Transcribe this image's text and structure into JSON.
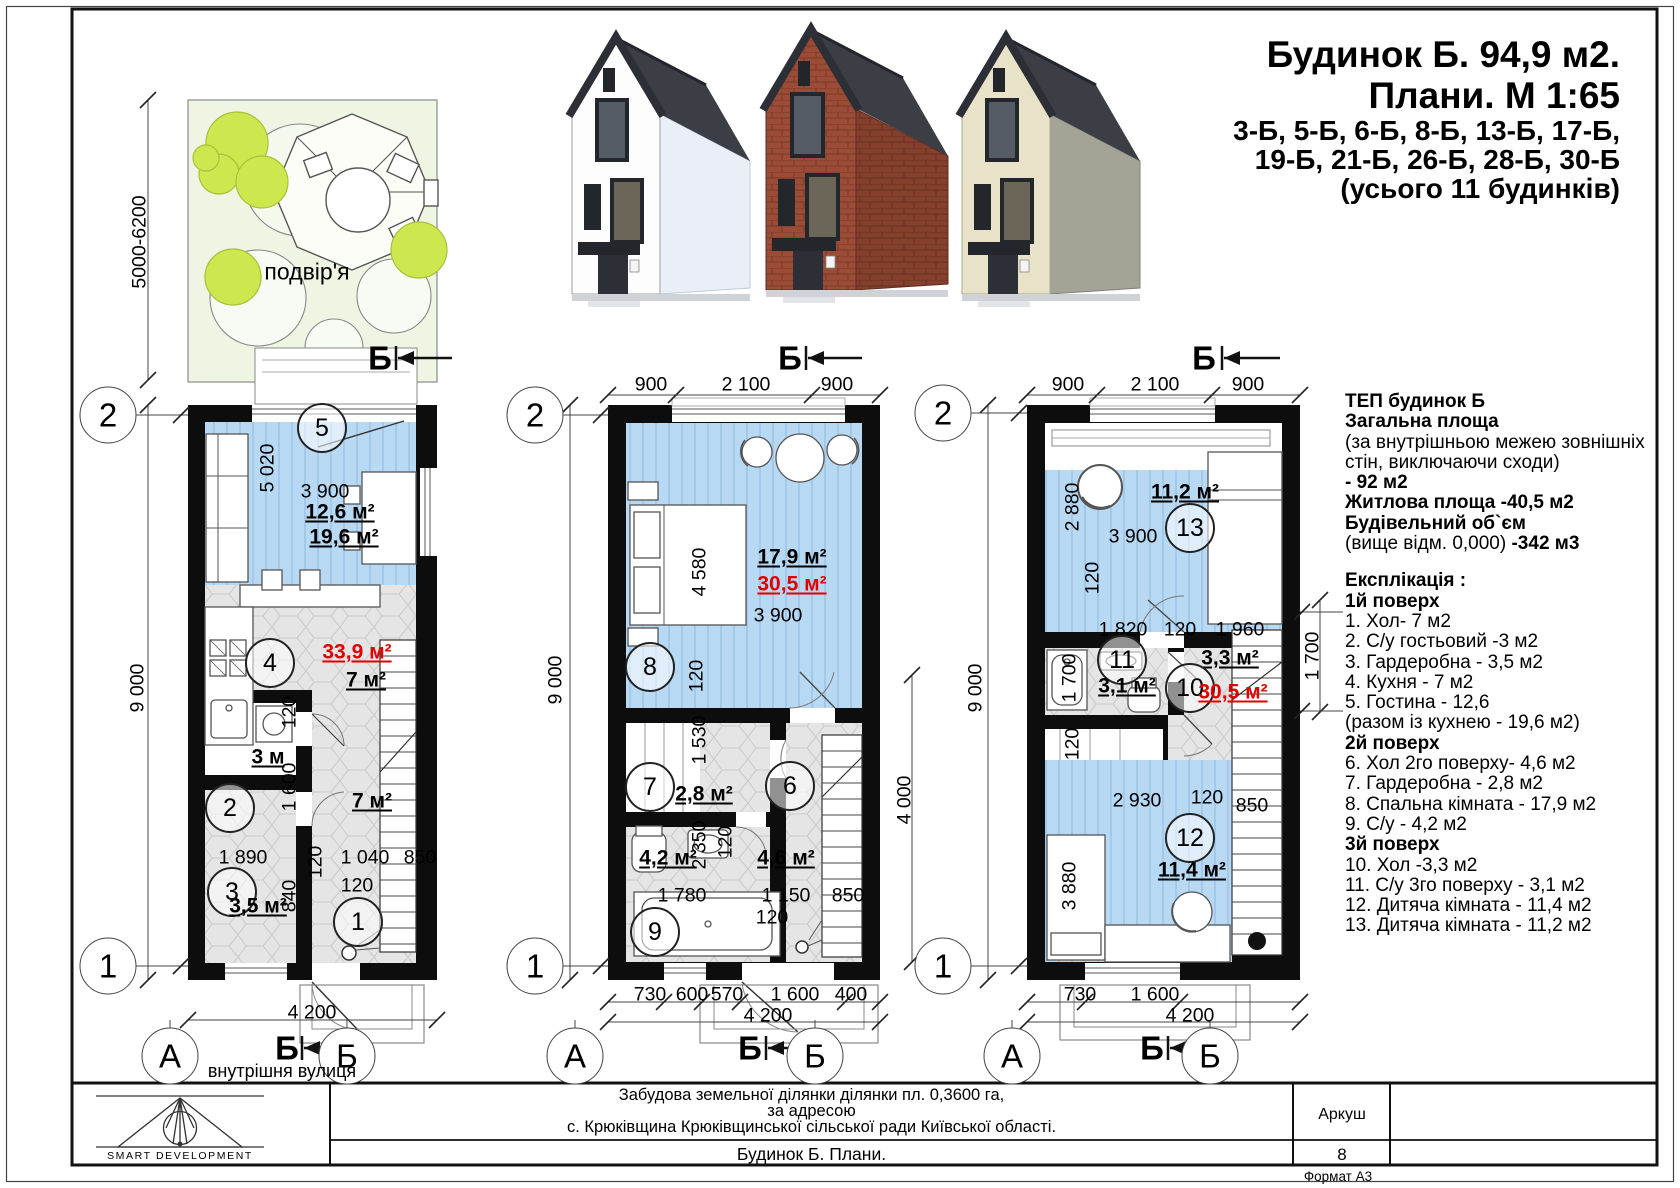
{
  "colors": {
    "accent_red": "#e10000",
    "room_blue": "#b8d9f3",
    "floor_hex_gray": "#e5e5e5",
    "yard_green": "#eef6e3",
    "tree_green": "#cde74f",
    "wall_black": "#0d0d0d"
  },
  "title": {
    "l1": "Будинок Б. 94,9 м2.",
    "l2": "Плани. М 1:65",
    "l3": "3-Б, 5-Б, 6-Б, 8-Б, 13-Б, 17-Б,",
    "l4": "19-Б,  21-Б,  26-Б, 28-Б,  30-Б",
    "l5": "(усього 11 будинків)"
  },
  "info": {
    "lines": [
      {
        "t": "ТЕП будинок Б",
        "cls": "b"
      },
      {
        "t": "Загальна площа",
        "cls": "b"
      },
      {
        "t": "(за внутрішньою межею зовнішніх"
      },
      {
        "t": "стін, виключаючи сходи)"
      },
      {
        "t": "- 92 м2",
        "cls": "b"
      },
      {
        "t": "Житлова площа -40,5 м2",
        "cls": "b"
      },
      {
        "t": "Будівельний об`єм",
        "cls": "b"
      },
      {
        "t": "(вище відм. 0,000) ",
        "t2": "-342 м3"
      },
      {
        "t": "",
        "cls": "gap"
      },
      {
        "t": "Експлікація :",
        "cls": "b"
      },
      {
        "t": "1й поверх",
        "cls": "b"
      },
      {
        "t": "1. Хол- 7 м2"
      },
      {
        "t": "2. С/у гостьовий -3 м2"
      },
      {
        "t": "3. Гардеробна - 3,5 м2"
      },
      {
        "t": "4. Кухня - 7 м2"
      },
      {
        "t": "5. Гостина - 12,6"
      },
      {
        "t": "(разом із кухнею - 19,6 м2)"
      },
      {
        "t": "2й поверх",
        "cls": "b"
      },
      {
        "t": "6. Хол 2го поверху- 4,6 м2"
      },
      {
        "t": "7. Гардеробна - 2,8 м2"
      },
      {
        "t": "8. Спальна кімната - 17,9 м2"
      },
      {
        "t": "9. С/у - 4,2 м2"
      },
      {
        "t": "3й поверх",
        "cls": "b"
      },
      {
        "t": "10. Хол -3,3 м2"
      },
      {
        "t": "11. С/у 3го поверху - 3,1 м2"
      },
      {
        "t": "12. Дитяча кімната - 11,4 м2"
      },
      {
        "t": "13. Дитяча кімната - 11,2 м2"
      }
    ]
  },
  "titleblock": {
    "project1": "Забудова земельної ділянки  ділянки пл. 0,3600 га,",
    "project2": "за адресою",
    "project3": "с. Крюківщина Крюківщинської сільської ради Київської області.",
    "doc_title": "Будинок Б. Плани.",
    "sheet_label": "Аркуш",
    "sheet_no": "8",
    "format": "Формат А3",
    "logo": "SMART DEVELOPMENT"
  },
  "labels": {
    "common": [
      {
        "t": "2",
        "x": 108,
        "y": 415,
        "cls": "grid"
      },
      {
        "t": "1",
        "x": 108,
        "y": 966,
        "cls": "grid"
      },
      {
        "t": "2",
        "x": 535,
        "y": 415,
        "cls": "grid"
      },
      {
        "t": "1",
        "x": 535,
        "y": 966,
        "cls": "grid"
      },
      {
        "t": "2",
        "x": 943,
        "y": 413,
        "cls": "grid"
      },
      {
        "t": "1",
        "x": 943,
        "y": 966,
        "cls": "grid"
      },
      {
        "t": "А",
        "x": 170,
        "y": 1056,
        "cls": "grid"
      },
      {
        "t": "Б",
        "x": 347,
        "y": 1056,
        "cls": "grid"
      },
      {
        "t": "А",
        "x": 575,
        "y": 1056,
        "cls": "grid"
      },
      {
        "t": "Б",
        "x": 815,
        "y": 1056,
        "cls": "grid"
      },
      {
        "t": "А",
        "x": 1012,
        "y": 1056,
        "cls": "grid"
      },
      {
        "t": "Б",
        "x": 1210,
        "y": 1056,
        "cls": "grid"
      },
      {
        "t": "Б",
        "x": 380,
        "y": 358,
        "cls": "sec"
      },
      {
        "t": "Б",
        "x": 790,
        "y": 358,
        "cls": "sec"
      },
      {
        "t": "Б",
        "x": 1204,
        "y": 358,
        "cls": "sec"
      },
      {
        "t": "Б",
        "x": 287,
        "y": 1048,
        "cls": "sec"
      },
      {
        "t": "Б",
        "x": 750,
        "y": 1048,
        "cls": "sec"
      },
      {
        "t": "Б",
        "x": 1152,
        "y": 1048,
        "cls": "sec"
      },
      {
        "t": "подвір'я",
        "x": 307,
        "y": 272,
        "cls": "yard"
      },
      {
        "t": "внутрішня вулиця",
        "x": 282,
        "y": 1071,
        "cls": "street"
      },
      {
        "t": "5000-6200",
        "x": 140,
        "y": 242,
        "cls": "rot"
      }
    ],
    "floor1": [
      {
        "t": "9 000",
        "x": 138,
        "y": 688,
        "cls": "rot"
      },
      {
        "t": "5 020",
        "x": 268,
        "y": 468,
        "cls": "rot"
      },
      {
        "t": "3 900",
        "x": 325,
        "y": 492
      },
      {
        "t": "12,6 м²",
        "x": 340,
        "y": 512,
        "cls": "area"
      },
      {
        "t": "19,6 м²",
        "x": 344,
        "y": 537,
        "cls": "area"
      },
      {
        "t": "5",
        "x": 322,
        "y": 428,
        "cls": "room"
      },
      {
        "t": "4",
        "x": 270,
        "y": 663,
        "cls": "room"
      },
      {
        "t": "33,9 м²",
        "x": 357,
        "y": 652,
        "cls": "area red"
      },
      {
        "t": "7 м²",
        "x": 366,
        "y": 680,
        "cls": "area"
      },
      {
        "t": "120",
        "x": 290,
        "y": 712,
        "cls": "rot"
      },
      {
        "t": "3 м",
        "x": 268,
        "y": 757,
        "cls": "area"
      },
      {
        "t": "2",
        "x": 230,
        "y": 808,
        "cls": "room"
      },
      {
        "t": "1 600",
        "x": 290,
        "y": 787,
        "cls": "rot"
      },
      {
        "t": "7 м²",
        "x": 372,
        "y": 801,
        "cls": "area"
      },
      {
        "t": "1 890",
        "x": 243,
        "y": 858
      },
      {
        "t": "120",
        "x": 316,
        "y": 862,
        "cls": "rot"
      },
      {
        "t": "1 040",
        "x": 365,
        "y": 858
      },
      {
        "t": "850",
        "x": 420,
        "y": 858
      },
      {
        "t": "120",
        "x": 357,
        "y": 886
      },
      {
        "t": "840",
        "x": 290,
        "y": 896,
        "cls": "rot"
      },
      {
        "t": "3",
        "x": 232,
        "y": 892,
        "cls": "room"
      },
      {
        "t": "3,5 м²",
        "x": 258,
        "y": 906,
        "cls": "area"
      },
      {
        "t": "1",
        "x": 358,
        "y": 922,
        "cls": "room"
      },
      {
        "t": "4 200",
        "x": 312,
        "y": 1013
      }
    ],
    "floor2": [
      {
        "t": "900",
        "x": 651,
        "y": 385
      },
      {
        "t": "2 100",
        "x": 746,
        "y": 385
      },
      {
        "t": "900",
        "x": 837,
        "y": 385
      },
      {
        "t": "9 000",
        "x": 556,
        "y": 680,
        "cls": "rot"
      },
      {
        "t": "4 580",
        "x": 700,
        "y": 572,
        "cls": "rot"
      },
      {
        "t": "17,9 м²",
        "x": 792,
        "y": 557,
        "cls": "area"
      },
      {
        "t": "30,5 м²",
        "x": 792,
        "y": 584,
        "cls": "area red"
      },
      {
        "t": "3 900",
        "x": 778,
        "y": 616
      },
      {
        "t": "8",
        "x": 650,
        "y": 667,
        "cls": "room"
      },
      {
        "t": "120",
        "x": 697,
        "y": 676,
        "cls": "rot"
      },
      {
        "t": "1 530",
        "x": 700,
        "y": 740,
        "cls": "rot"
      },
      {
        "t": "7",
        "x": 650,
        "y": 787,
        "cls": "room"
      },
      {
        "t": "2,8 м²",
        "x": 704,
        "y": 794,
        "cls": "area"
      },
      {
        "t": "6",
        "x": 790,
        "y": 786,
        "cls": "room"
      },
      {
        "t": "2 350",
        "x": 700,
        "y": 845,
        "cls": "rot"
      },
      {
        "t": "120",
        "x": 726,
        "y": 842,
        "cls": "rot"
      },
      {
        "t": "4,6 м²",
        "x": 786,
        "y": 858,
        "cls": "area"
      },
      {
        "t": "4,2 м²",
        "x": 668,
        "y": 858,
        "cls": "area"
      },
      {
        "t": "1 780",
        "x": 682,
        "y": 896
      },
      {
        "t": "1 150",
        "x": 786,
        "y": 896
      },
      {
        "t": "850",
        "x": 848,
        "y": 896
      },
      {
        "t": "120",
        "x": 772,
        "y": 918
      },
      {
        "t": "9",
        "x": 655,
        "y": 932,
        "cls": "room"
      },
      {
        "t": "4 000",
        "x": 905,
        "y": 800,
        "cls": "rot"
      },
      {
        "t": "730",
        "x": 650,
        "y": 995
      },
      {
        "t": "600",
        "x": 692,
        "y": 995
      },
      {
        "t": "570",
        "x": 727,
        "y": 995
      },
      {
        "t": "1 600",
        "x": 795,
        "y": 995
      },
      {
        "t": "400",
        "x": 851,
        "y": 995
      },
      {
        "t": "4 200",
        "x": 768,
        "y": 1016
      }
    ],
    "floor3": [
      {
        "t": "900",
        "x": 1068,
        "y": 385
      },
      {
        "t": "2 100",
        "x": 1155,
        "y": 385
      },
      {
        "t": "900",
        "x": 1248,
        "y": 385
      },
      {
        "t": "9 000",
        "x": 976,
        "y": 688,
        "cls": "rot"
      },
      {
        "t": "2 880",
        "x": 1073,
        "y": 507,
        "cls": "rot"
      },
      {
        "t": "11,2 м²",
        "x": 1185,
        "y": 492,
        "cls": "area"
      },
      {
        "t": "13",
        "x": 1190,
        "y": 528,
        "cls": "room"
      },
      {
        "t": "3 900",
        "x": 1133,
        "y": 537
      },
      {
        "t": "120",
        "x": 1093,
        "y": 578,
        "cls": "rot"
      },
      {
        "t": "1 820",
        "x": 1123,
        "y": 630
      },
      {
        "t": "120",
        "x": 1180,
        "y": 630
      },
      {
        "t": "1 960",
        "x": 1240,
        "y": 630
      },
      {
        "t": "11",
        "x": 1122,
        "y": 660,
        "cls": "room"
      },
      {
        "t": "3,3 м²",
        "x": 1230,
        "y": 658,
        "cls": "area"
      },
      {
        "t": "3,1 м²",
        "x": 1127,
        "y": 686,
        "cls": "area"
      },
      {
        "t": "10",
        "x": 1190,
        "y": 688,
        "cls": "room"
      },
      {
        "t": "30,5 м²",
        "x": 1233,
        "y": 692,
        "cls": "area red"
      },
      {
        "t": "1 700",
        "x": 1070,
        "y": 678,
        "cls": "rot"
      },
      {
        "t": "1 700",
        "x": 1313,
        "y": 656,
        "cls": "rot"
      },
      {
        "t": "120",
        "x": 1073,
        "y": 744,
        "cls": "rot"
      },
      {
        "t": "2 930",
        "x": 1137,
        "y": 801
      },
      {
        "t": "120",
        "x": 1207,
        "y": 798
      },
      {
        "t": "850",
        "x": 1252,
        "y": 806
      },
      {
        "t": "12",
        "x": 1190,
        "y": 838,
        "cls": "room"
      },
      {
        "t": "11,4 м²",
        "x": 1192,
        "y": 870,
        "cls": "area"
      },
      {
        "t": "3 880",
        "x": 1070,
        "y": 886,
        "cls": "rot"
      },
      {
        "t": "730",
        "x": 1080,
        "y": 995
      },
      {
        "t": "1 600",
        "x": 1155,
        "y": 995
      },
      {
        "t": "4 200",
        "x": 1190,
        "y": 1016
      }
    ]
  }
}
